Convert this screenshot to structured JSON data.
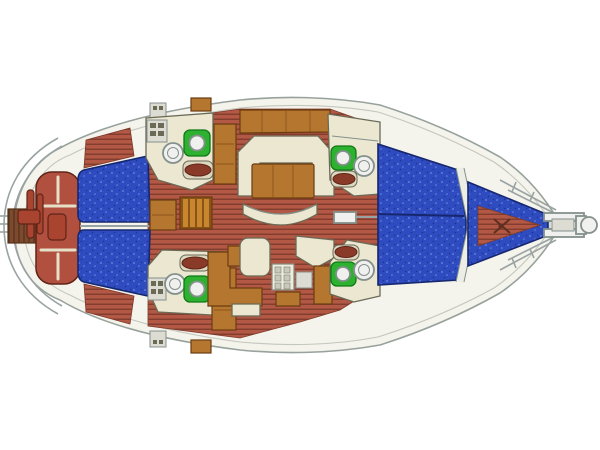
{
  "meta": {
    "title": "Sailing Yacht Interior Deck Plan",
    "type": "yacht-floor-plan",
    "view": "top-down",
    "orientation": "bow-right"
  },
  "palette": {
    "background": "#ffffff",
    "hull_fill": "#f4f3ec",
    "hull_stroke": "#98a29c",
    "deck_line": "#c3c7bd",
    "sole_base": "#b25844",
    "sole_line": "#7d3a2b",
    "berth_base": "#2e4cc0",
    "berth_speckle_light": "#7288dd",
    "berth_speckle_dark": "#1c338f",
    "berth_stroke": "#16276f",
    "furniture_cream": "#ebe7d1",
    "furniture_stroke": "#6a6a56",
    "furniture_pad": "#dcd8c0",
    "wood": "#b5762f",
    "wood_dark": "#8a5318",
    "wood_stroke": "#6b3c0f",
    "wood_slat": "#c8872f",
    "cockpit_seat": "#b25040",
    "cockpit_seat_dark": "#a8442f",
    "cockpit_stroke": "#5f2418",
    "cockpit_seam": "#e5e0c8",
    "walkway": "#7c4a2e",
    "walkway_line": "#553018",
    "toilet_green": "#2eb130",
    "toilet_stroke": "#0f7a14",
    "fixture_white": "#f0f1ee",
    "fixture_ring": "#84908c",
    "basin_red": "#8a3a28",
    "rail": "#9aa3a3",
    "hatch_gray": "#dcdcd2",
    "stove_face": "#ededdf",
    "stove_grid": "#c9c9bb",
    "stove_stroke": "#88887a",
    "bulkhead_band": "#ecede4",
    "anchor_dark": "#5f2f1f"
  },
  "legend": {
    "blue_areas": "berth cushions",
    "red_brown_striped": "cabin sole / teak flooring",
    "cream_areas": "seating, counters and head compartments",
    "orange_wood": "joinery, table, galley counters",
    "green_fixtures": "marine toilets",
    "white_circles": "wash basins / sinks"
  },
  "compartments": [
    {
      "id": "swim-platform",
      "desc": "stern boarding walkway with ladder"
    },
    {
      "id": "cockpit",
      "desc": "cockpit benches with wheel steering pedestal"
    },
    {
      "id": "aft-cabin-port",
      "desc": "port aft double berth"
    },
    {
      "id": "aft-cabin-starboard",
      "desc": "starboard aft double berth"
    },
    {
      "id": "aft-head-port",
      "desc": "port aft head with sink, toilet, basin"
    },
    {
      "id": "aft-head-starboard",
      "desc": "starboard aft head with sink, toilet, basin"
    },
    {
      "id": "companionway",
      "desc": "companionway steps and cabinet"
    },
    {
      "id": "saloon",
      "desc": "U-shaped settee, drop-leaf table, curved bench"
    },
    {
      "id": "galley",
      "desc": "L-shaped galley with stove and counters"
    },
    {
      "id": "forward-head-port",
      "desc": "port forward head"
    },
    {
      "id": "forward-head-starboard",
      "desc": "starboard forward head"
    },
    {
      "id": "forward-cabin",
      "desc": "forward double berth"
    },
    {
      "id": "forepeak",
      "desc": "bow berth and anchor locker"
    },
    {
      "id": "bow-pulpit",
      "desc": "bow pulpit rails and anchor roller"
    }
  ]
}
